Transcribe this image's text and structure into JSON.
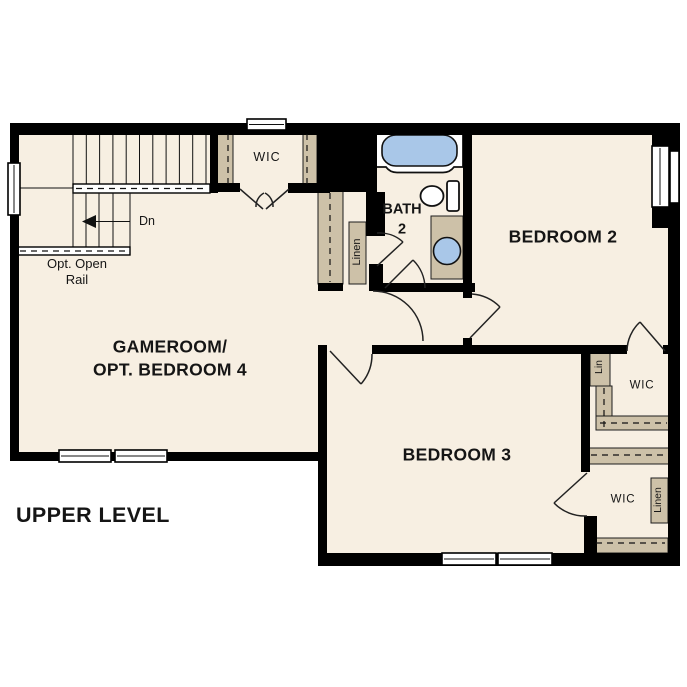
{
  "colors": {
    "wall": "#000000",
    "room": "#f7efe2",
    "accent_tan": "#cdc1a8",
    "fixture_blue": "#a9c7e8",
    "line": "#1a1a1a",
    "background": "#ffffff"
  },
  "labels": {
    "gameroom": "GAMEROOM/\nOPT. BEDROOM 4",
    "bedroom2": "BEDROOM 2",
    "bedroom3": "BEDROOM 3",
    "bath": "BATH\n2",
    "wic_main": "WIC",
    "wic_bedroom2": "WIC",
    "wic_bedroom3": "WIC",
    "lin": "Lin",
    "linen_hall": "Linen",
    "linen_wic": "Linen",
    "stairs_down": "Dn",
    "opt_open_rail": "Opt. Open\nRail",
    "level": "UPPER LEVEL"
  }
}
